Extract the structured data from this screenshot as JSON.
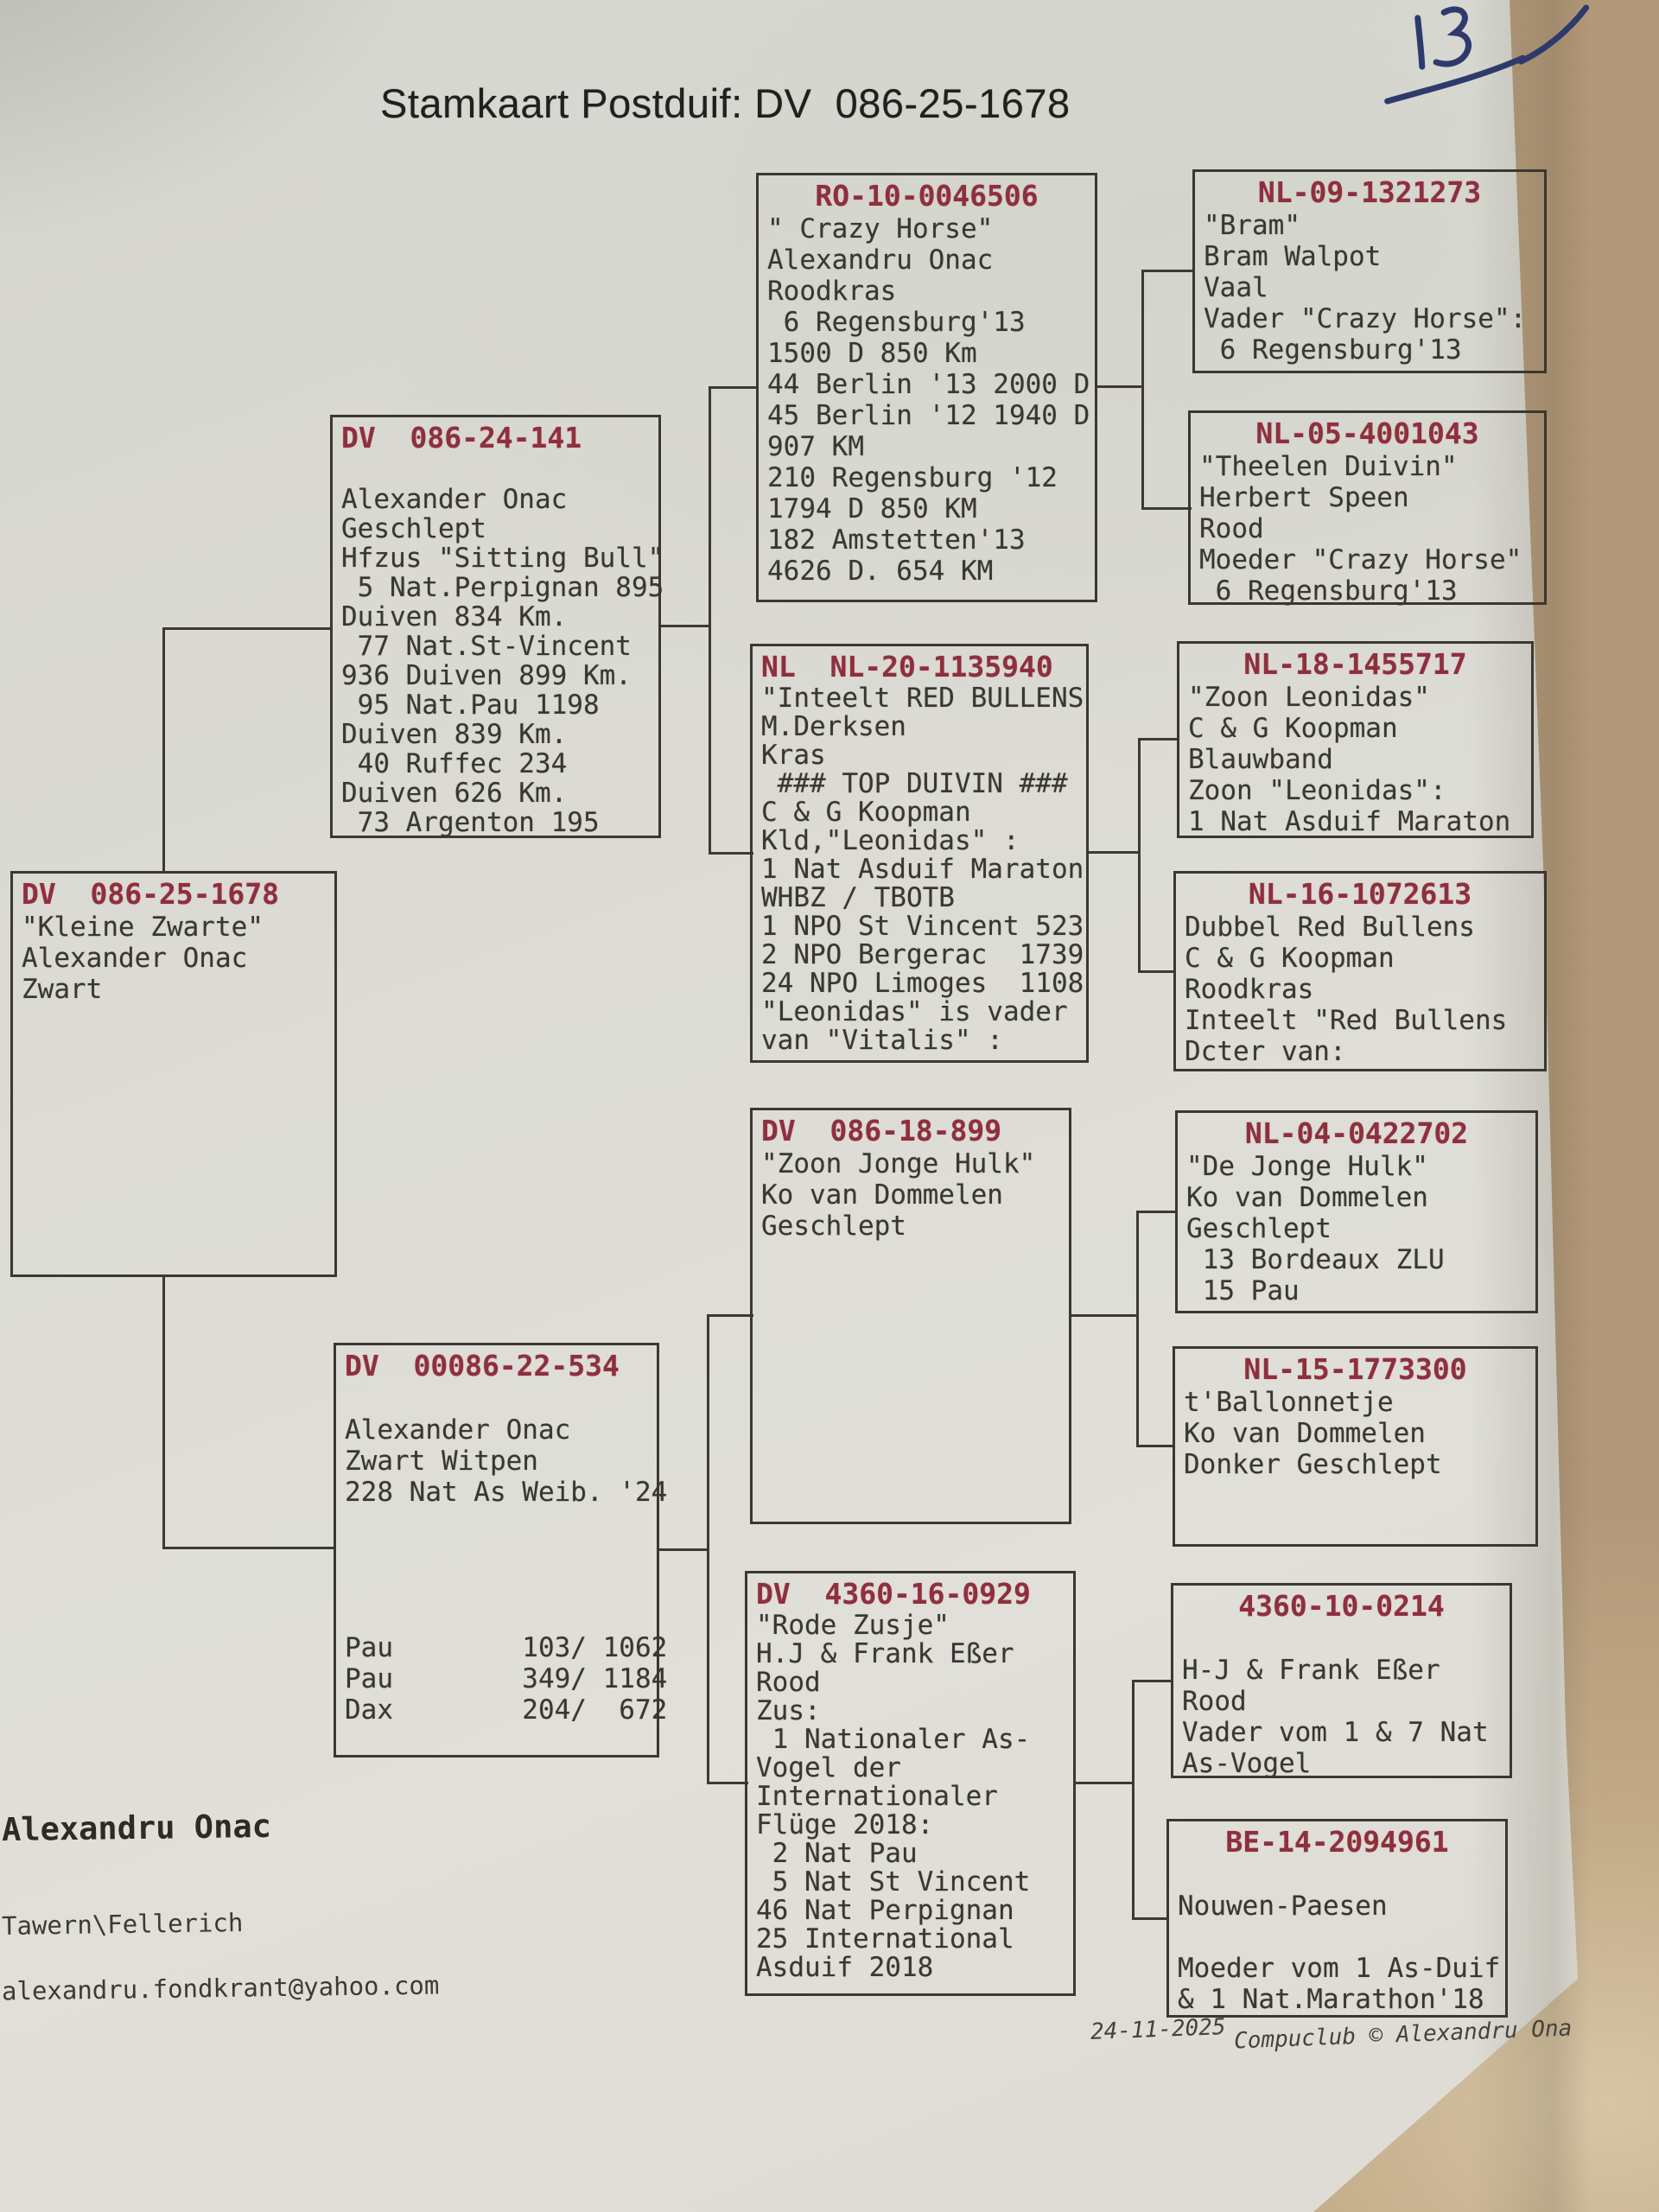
{
  "title": "Stamkaart Postduif: DV  086-25-1678",
  "handwritten_note": "13",
  "colors": {
    "ring_red": "#8f2f3e",
    "ink_blue": "#2e3a6b",
    "line_dark": "#3c3a31",
    "paper": "#dbdad4",
    "table_tan": "#b59b7c"
  },
  "owner": {
    "name": "Alexandru Onac",
    "location": "Tawern\\Fellerich",
    "email": "alexandru.fondkrant@yahoo.com"
  },
  "footer": {
    "date": "24-11-2025",
    "credit": "Compuclub © Alexandru Ona"
  },
  "boxes": [
    {
      "id": "subject",
      "ring": "DV  086-25-1678",
      "lines": [
        "\"Kleine Zwarte\"",
        "Alexander Onac",
        "Zwart"
      ]
    },
    {
      "id": "father",
      "ring": "DV  086-24-141",
      "lines": [
        "",
        "Alexander Onac",
        "Geschlept",
        "Hfzus \"Sitting Bull\"",
        " 5 Nat.Perpignan 895",
        "Duiven 834 Km.",
        " 77 Nat.St-Vincent",
        "936 Duiven 899 Km.",
        " 95 Nat.Pau 1198",
        "Duiven 839 Km.",
        " 40 Ruffec 234",
        "Duiven 626 Km.",
        " 73 Argenton 195"
      ]
    },
    {
      "id": "mother",
      "ring": "DV  00086-22-534",
      "lines": [
        "",
        "Alexander Onac",
        "Zwart Witpen",
        "228 Nat As Weib. '24",
        "",
        "",
        "",
        "",
        "Pau        103/ 1062",
        "Pau        349/ 1184",
        "Dax        204/  672"
      ]
    },
    {
      "id": "pgf",
      "ring": "RO-10-0046506",
      "lines": [
        "\" Crazy Horse\"",
        "Alexandru Onac",
        "Roodkras",
        " 6 Regensburg'13",
        "1500 D 850 Km",
        "44 Berlin '13 2000 D",
        "45 Berlin '12 1940 D",
        "907 KM",
        "210 Regensburg '12",
        "1794 D 850 KM",
        "182 Amstetten'13",
        "4626 D. 654 KM"
      ]
    },
    {
      "id": "pgm",
      "ring": "NL  NL-20-1135940",
      "lines": [
        "\"Inteelt RED BULLENS",
        "M.Derksen",
        "Kras",
        " ### TOP DUIVIN ###",
        "C & G Koopman",
        "Kld,\"Leonidas\" :",
        "1 Nat Asduif Maraton",
        "WHBZ / TBOTB",
        "1 NPO St Vincent 523",
        "2 NPO Bergerac  1739",
        "24 NPO Limoges  1108",
        "\"Leonidas\" is vader",
        "van \"Vitalis\" :"
      ]
    },
    {
      "id": "mgf",
      "ring": "DV  086-18-899",
      "lines": [
        "\"Zoon Jonge Hulk\"",
        "Ko van Dommelen",
        "Geschlept"
      ]
    },
    {
      "id": "mgm",
      "ring": "DV  4360-16-0929",
      "lines": [
        "\"Rode Zusje\"",
        "H.J & Frank Eßer",
        "Rood",
        "Zus:",
        " 1 Nationaler As-",
        "Vogel der",
        "Internationaler",
        "Flüge 2018:",
        " 2 Nat Pau",
        " 5 Nat St Vincent",
        "46 Nat Perpignan",
        "25 International",
        "Asduif 2018"
      ]
    },
    {
      "id": "ggf1",
      "ring": "NL-09-1321273",
      "lines": [
        "\"Bram\"",
        "Bram Walpot",
        "Vaal",
        "Vader \"Crazy Horse\":",
        " 6 Regensburg'13"
      ]
    },
    {
      "id": "ggm1",
      "ring": "NL-05-4001043",
      "lines": [
        "\"Theelen Duivin\"",
        "Herbert Speen",
        "Rood",
        "Moeder \"Crazy Horse\"",
        " 6 Regensburg'13"
      ]
    },
    {
      "id": "ggf2",
      "ring": "NL-18-1455717",
      "lines": [
        "\"Zoon Leonidas\"",
        "C & G Koopman",
        "Blauwband",
        "Zoon \"Leonidas\":",
        "1 Nat Asduif Maraton"
      ]
    },
    {
      "id": "ggm2",
      "ring": "NL-16-1072613",
      "lines": [
        "Dubbel Red Bullens",
        "C & G Koopman",
        "Roodkras",
        "Inteelt \"Red Bullens",
        "Dcter van:"
      ]
    },
    {
      "id": "ggf3",
      "ring": "NL-04-0422702",
      "lines": [
        "\"De Jonge Hulk\"",
        "Ko van Dommelen",
        "Geschlept",
        " 13 Bordeaux ZLU",
        " 15 Pau"
      ]
    },
    {
      "id": "ggm3",
      "ring": "NL-15-1773300",
      "lines": [
        "t'Ballonnetje",
        "Ko van Dommelen",
        "Donker Geschlept"
      ]
    },
    {
      "id": "ggf4",
      "ring": "4360-10-0214",
      "lines": [
        "",
        "H-J & Frank Eßer",
        "Rood",
        "Vader vom 1 & 7 Nat",
        "As-Vogel"
      ]
    },
    {
      "id": "ggm4",
      "ring": "BE-14-2094961",
      "lines": [
        "",
        "Nouwen-Paesen",
        "",
        "Moeder vom 1 As-Duif",
        "& 1 Nat.Marathon'18"
      ]
    }
  ]
}
